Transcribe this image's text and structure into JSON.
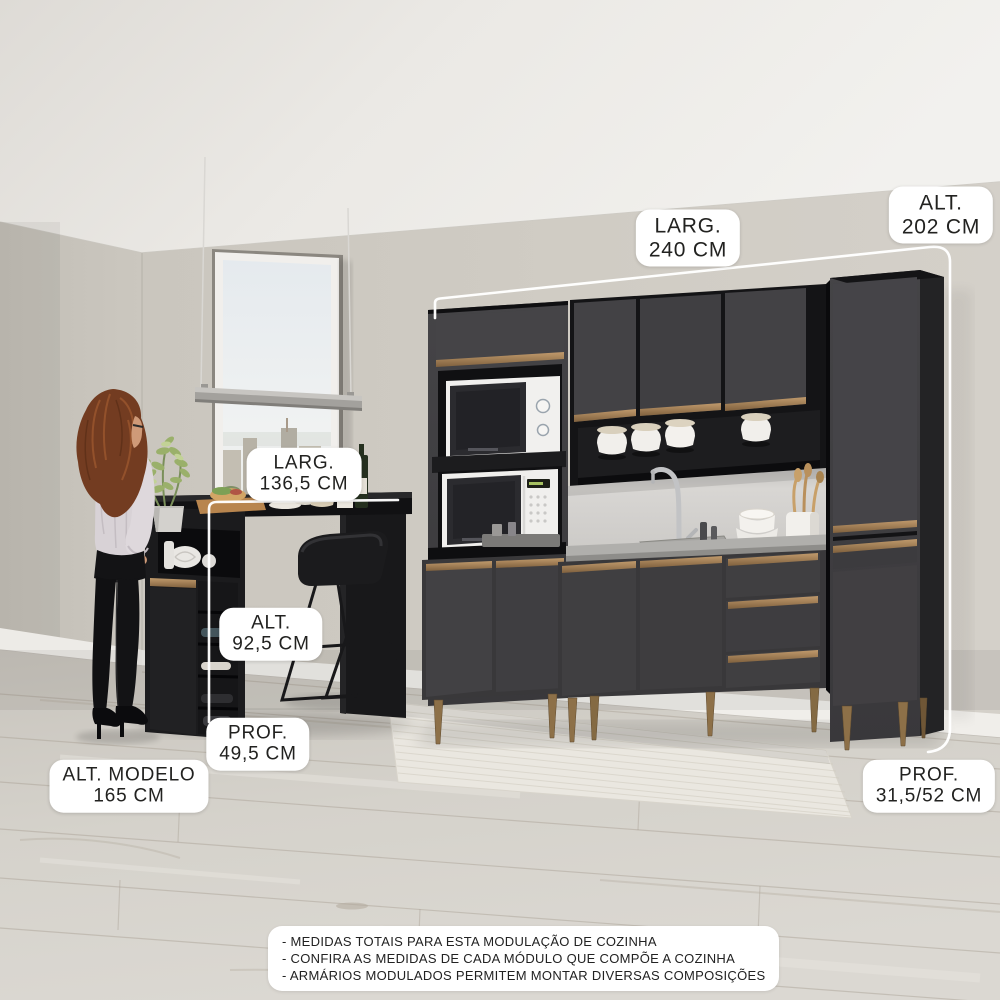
{
  "measurements": {
    "kitchen_width": {
      "label": "LARG.",
      "value": "240 CM"
    },
    "kitchen_height": {
      "label": "ALT.",
      "value": "202 CM"
    },
    "table_width": {
      "label": "LARG.",
      "value": "136,5 CM"
    },
    "table_height": {
      "label": "ALT.",
      "value": "92,5 CM"
    },
    "table_depth": {
      "label": "PROF.",
      "value": "49,5 CM"
    },
    "model_height": {
      "label": "ALT. MODELO",
      "value": "165 CM"
    },
    "kitchen_depth": {
      "label": "PROF.",
      "value": "31,5/52 CM"
    }
  },
  "notes": [
    "- MEDIDAS TOTAIS PARA ESTA MODULAÇÃO DE COZINHA",
    "- CONFIRA AS MEDIDAS DE CADA MÓDULO QUE COMPÕE A COZINHA",
    "- ARMÁRIOS MODULADOS PERMITEM MONTAR DIVERSAS COMPOSIÇÕES"
  ],
  "colors": {
    "cabinet": "#3e3d40",
    "cabinet_dark": "#19191b",
    "handle_bronze": "#a5825a",
    "counter": "#aeadaa",
    "wall": "#cfcbc3",
    "floor": "#d4d1ca",
    "rug": "#eae7e0",
    "label_bg": "#ffffff",
    "label_text": "#222220",
    "measure_line": "#ffffff"
  },
  "scene": {
    "objects": [
      "kitchen-cabinet-set",
      "microwave-top",
      "microwave-bottom",
      "bar-table",
      "bar-stool",
      "wine-rack",
      "pendant-lamp",
      "window-city-view",
      "woman-standing",
      "potted-plant",
      "rug",
      "wood-floor"
    ]
  }
}
